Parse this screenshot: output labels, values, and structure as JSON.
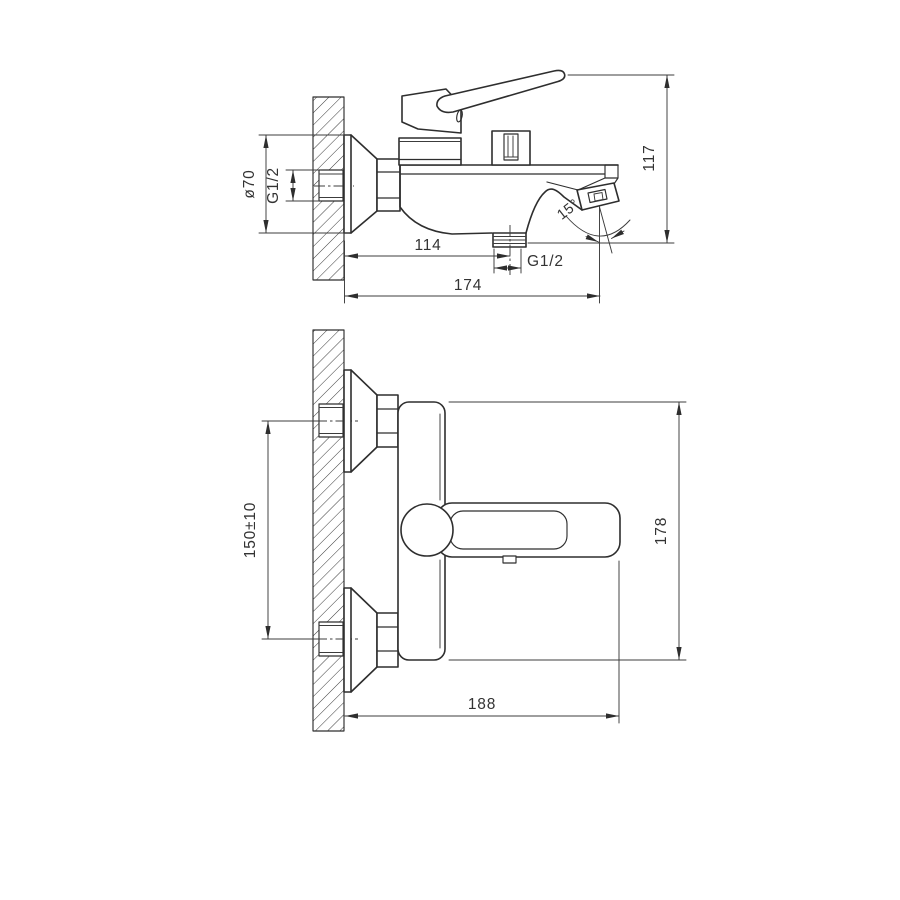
{
  "drawing": {
    "background": "#ffffff",
    "line_color": "#2e2e2e",
    "side_view": {
      "dim_flange_diameter": "ø70",
      "dim_inlet_thread": "G1/2",
      "dim_total_height": "117",
      "dim_wall_to_shower_outlet": "114",
      "dim_shower_outlet_thread": "G1/2",
      "dim_wall_to_spout_tip": "174",
      "dim_spout_angle": "15°"
    },
    "front_view": {
      "dim_inlet_centers": "150±10",
      "dim_body_height": "178",
      "dim_wall_to_handle_tip": "188"
    }
  }
}
